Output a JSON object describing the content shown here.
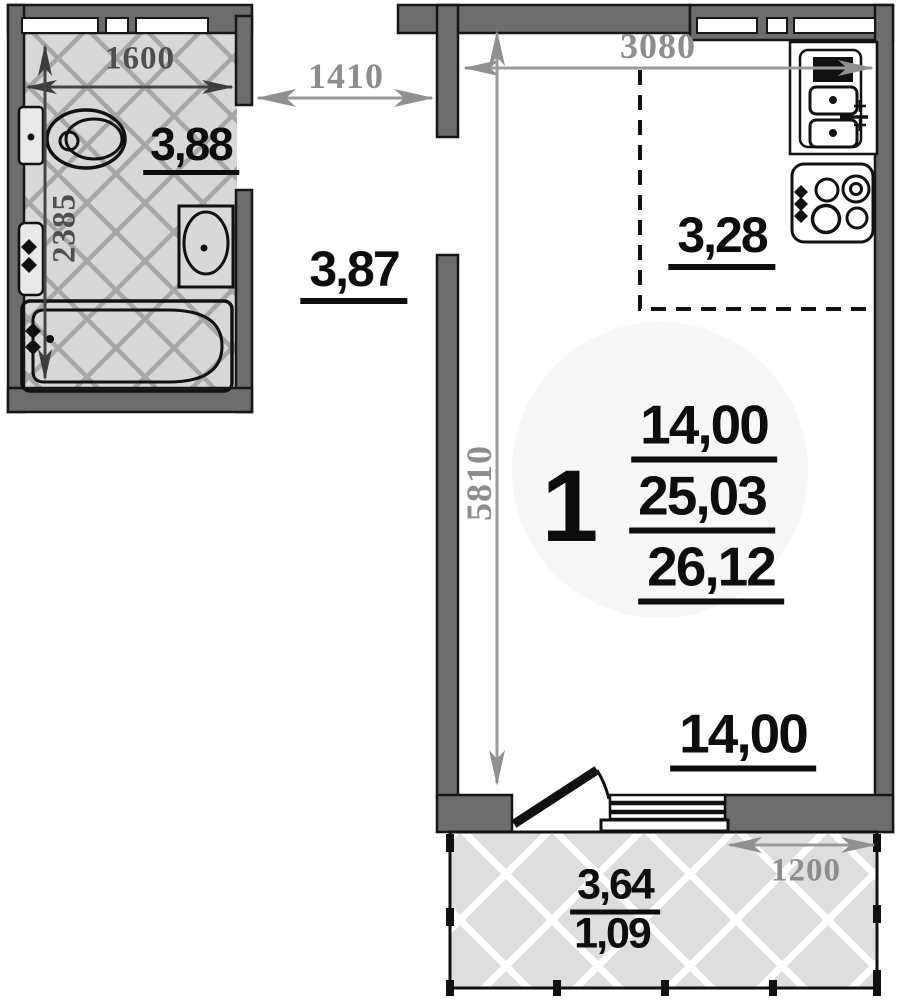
{
  "unit_summary": {
    "room_count": "1",
    "living_area": "14,00",
    "apartment_area": "25,03",
    "total_area": "26,12"
  },
  "areas": {
    "bathroom": "3,88",
    "hallway": "3,87",
    "kitchen": "3,28",
    "living_room": "14,00",
    "balcony": "3,64",
    "balcony_reduced": "1,09"
  },
  "dimensions_mm": {
    "bathroom_width": "1600",
    "bathroom_depth": "2385",
    "hallway_width": "1410",
    "room_width": "3080",
    "room_depth": "5810",
    "balcony_section_width": "1200"
  },
  "colors": {
    "wall_fill": "#6d6d6d",
    "outline": "#161616",
    "dim_light": "#8d8d8d",
    "dim_dark": "#4f4f4f",
    "label_text": "#0d0d0d",
    "tile_bg": "#d8d8d8",
    "tile_line": "#a6a6a6",
    "balcony_bg": "#dedede",
    "balcony_line": "#ffffff"
  }
}
